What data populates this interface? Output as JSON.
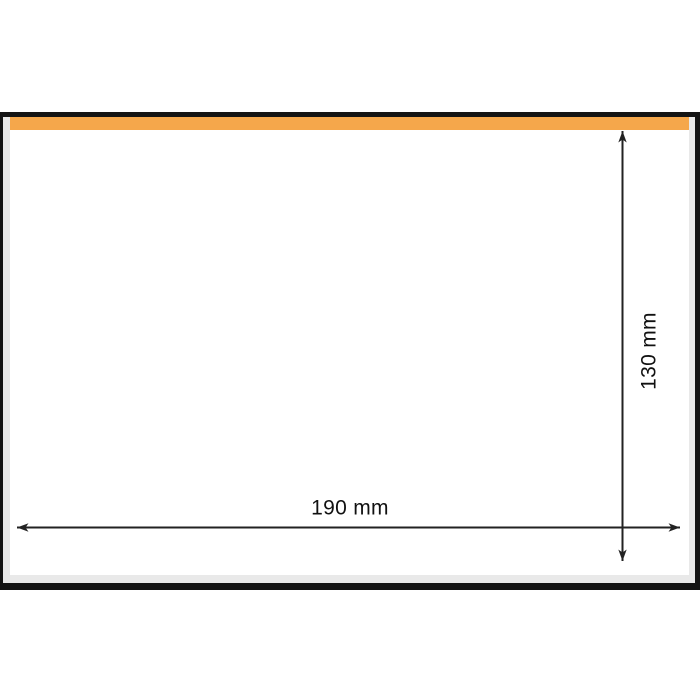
{
  "colors": {
    "outline": "#141414",
    "seal_strip": "#F5A74B",
    "edge_gray": "#E9E9E9",
    "face": "#FFFFFF",
    "arrow": "#222222",
    "label_text": "#111111"
  },
  "envelope": {
    "width_label": "190 mm",
    "height_label": "130 mm"
  }
}
